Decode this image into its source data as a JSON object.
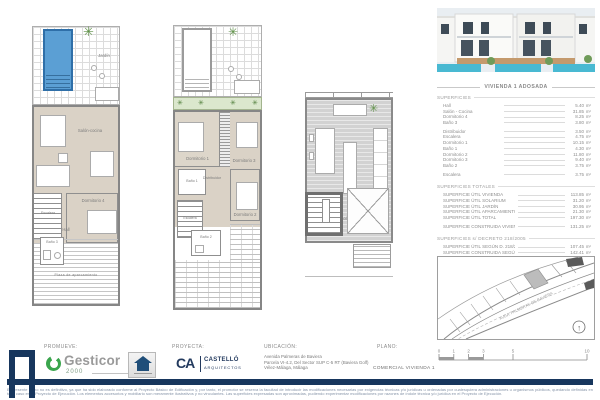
{
  "header": {
    "title": "VIVIENDA 1 ADOSADA"
  },
  "icons": {
    "tree": "✳",
    "plant": "✳",
    "north": "↑"
  },
  "plans": {
    "ground": {
      "jardin": "Jardín",
      "salon": "Salón-cocina",
      "escalera": "Escalera",
      "dormitorio4": "Dormitorio 4",
      "hall": "Hall",
      "bano3": "Baño 3",
      "aparcamiento": "Plaza de aparcamiento"
    },
    "first": {
      "dormitorio1": "Dormitorio 1",
      "dormitorio3": "Dormitorio 3",
      "bano1": "Baño 1",
      "distribuidor": "Distribuidor",
      "escalera": "Escalera",
      "dormitorio2": "Dormitorio 2",
      "bano2": "Baño 2"
    },
    "roof": {
      "solarium": "Solárium"
    }
  },
  "surfaces": {
    "title": "SUPERFICIES",
    "unit": "m²",
    "groups": [
      [
        {
          "label": "Hall",
          "value": "5.40"
        },
        {
          "label": "Salón - Cocina",
          "value": "31.85"
        },
        {
          "label": "Dormitorio 4",
          "value": "8.25"
        },
        {
          "label": "Baño 3",
          "value": "3.80"
        }
      ],
      [
        {
          "label": "Distribuidor",
          "value": "3.50"
        },
        {
          "label": "Escalera",
          "value": "4.75"
        },
        {
          "label": "Dormitorio 1",
          "value": "10.15"
        },
        {
          "label": "Baño 1",
          "value": "4.30"
        },
        {
          "label": "Dormitorio 2",
          "value": "11.80"
        },
        {
          "label": "Dormitorio 3",
          "value": "9.40"
        },
        {
          "label": "Baño 2",
          "value": "3.75"
        }
      ],
      [
        {
          "label": "Escalera",
          "value": "3.75"
        }
      ]
    ]
  },
  "totals": {
    "title": "SUPERFICIES TOTALES",
    "rows": [
      {
        "label": "SUPERFICIE ÚTIL VIVIENDA",
        "value": "113.85"
      },
      {
        "label": "SUPERFICIE ÚTIL SOLARIUM",
        "value": "31.20"
      },
      {
        "label": "SUPERFICIE ÚTIL JARDÍN",
        "value": "30.95"
      },
      {
        "label": "SUPERFICIE ÚTIL APARCAMIENTO",
        "value": "21.30"
      },
      {
        "label": "SUPERFICIE ÚTIL TOTAL",
        "value": "197.30"
      }
    ],
    "construida": {
      "label": "SUPERFICIE CONSTRUIDA VIVIENDA",
      "value": "131.25"
    }
  },
  "decreto": {
    "title": "SUPERFICIES s/ DECRETO 218/2005",
    "rows": [
      {
        "label": "SUPERFICIE ÚTIL SEGÚN D. 218/2005",
        "value": "107.45"
      },
      {
        "label": "SUPERFICIE CONSTRUIDA SEGÚN D. 218/2005",
        "value": "142.41"
      }
    ],
    "note": "Superficies aproximadas conforme al Proyecto Básico"
  },
  "siteplan": {
    "street_label": "AVDA. PALMERAS DE BAVIERA"
  },
  "titleblock": {
    "promueve_label": "PROMUEVE:",
    "promoter_name": "Gesticor",
    "promoter_year": "2000",
    "proyecta_label": "PROYECTA:",
    "architect_mark": "CA",
    "architect_line1": "CASTELLÓ",
    "architect_line2": "ARQUITECTOS",
    "ubicacion_label": "UBICACIÓN:",
    "address_line1": "Avenida Palmeras de Baviera",
    "address_line2": "Parcela VI-4.2, Del Sector SUP C-5 RT (Baviera Golf)",
    "address_line3": "Vélez-Málaga, Málaga",
    "plano_label": "PLANO:",
    "plano_value": "COMERCIAL VIVIENDA 1",
    "scale_ticks": [
      "0",
      "1",
      "2",
      "3",
      "5",
      "10"
    ]
  },
  "disclaimer": "El presente plano no es definitivo, ya que ha sido elaborado conforme al Proyecto Básico de Edificación y, por tanto, el promotor se reserva la facultad de introducir las modificaciones necesarias por exigencias técnicas y/o jurídicas u ordenadas por cualesquiera administraciones u organismos públicos, quedando definidas en todo caso en el Proyecto de Ejecución. Los elementos accesorios y mobiliario son meramente ilustrativos y no vinculantes. Las superficies expresadas son aproximadas, pudiendo experimentar modificaciones por razones de índole técnica y/o jurídica en el Proyecto de Ejecución.",
  "colors": {
    "accent_blue": "#17365d",
    "pool_blue": "#5b9fd4",
    "brand_green": "#3aa54d",
    "floor_beige": "#dad2c6"
  }
}
